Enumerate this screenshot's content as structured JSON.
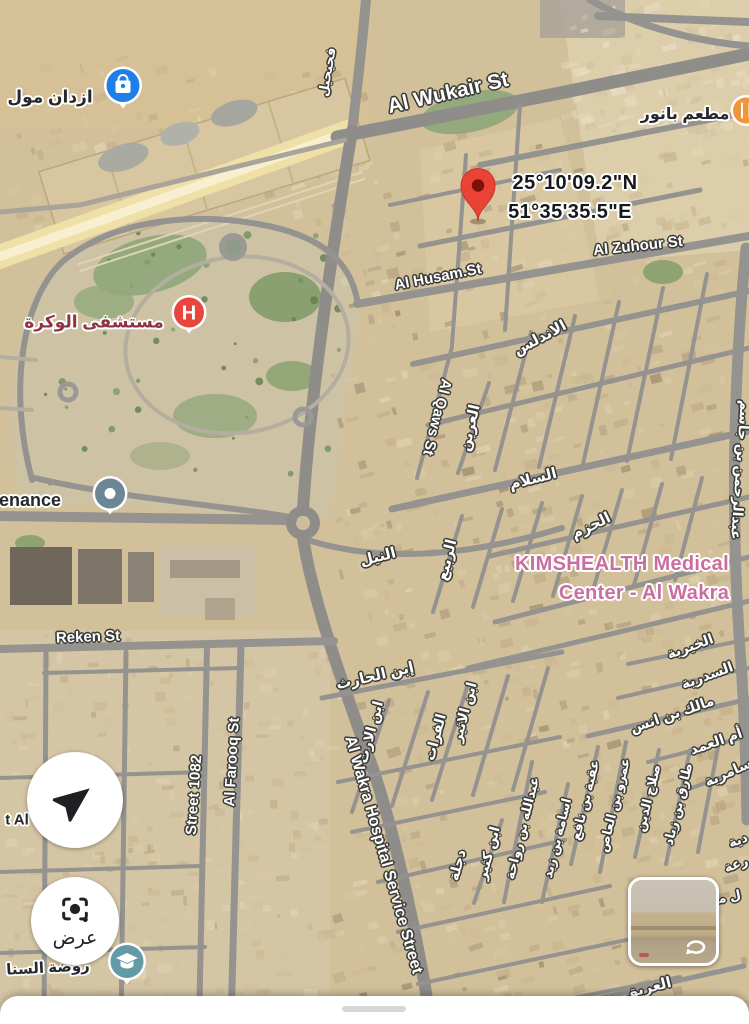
{
  "app": {
    "name": "maps-satellite-view"
  },
  "map": {
    "coordinates_label": {
      "line1": "25°10'09.2\"N",
      "line2": "51°35'35.5\"E"
    },
    "markers": {
      "hospital_letter": "H",
      "destination_pin": "dropped-pin",
      "mall": "shopping-bag-poi",
      "school": "graduation-cap-poi",
      "generic": "dot-poi",
      "restaurant": "restaurant-poi"
    },
    "labels": [
      {
        "t": "Al Wukair St",
        "x": 448,
        "y": 93,
        "r": -13,
        "s": 21,
        "c": "st",
        "n": "street-label-al-wukair"
      },
      {
        "t": "Al Husam.St",
        "x": 438,
        "y": 277,
        "r": -11,
        "s": 15,
        "c": "st",
        "n": "street-label-al-husam"
      },
      {
        "t": "Al Zuhour St",
        "x": 638,
        "y": 246,
        "r": -6,
        "s": 15,
        "c": "st",
        "n": "street-label-al-zuhour"
      },
      {
        "t": "Al Qaws St",
        "x": 437,
        "y": 417,
        "r": 104,
        "s": 15,
        "c": "st",
        "n": "street-label-al-qaws"
      },
      {
        "t": "Reken St",
        "x": 88,
        "y": 637,
        "r": -2,
        "s": 15,
        "c": "st",
        "n": "street-label-reken"
      },
      {
        "t": "Street 1082",
        "x": 194,
        "y": 795,
        "r": -86,
        "s": 15,
        "c": "st",
        "n": "street-label-1082"
      },
      {
        "t": "Al Farooq St",
        "x": 232,
        "y": 762,
        "r": -87,
        "s": 15,
        "c": "st",
        "n": "street-label-al-farooq"
      },
      {
        "t": "Al Wakra Hospital Service Street",
        "x": 383,
        "y": 855,
        "r": 74,
        "s": 16,
        "c": "st",
        "n": "street-label-hospital-service"
      },
      {
        "t": "العريق",
        "x": 648,
        "y": 988,
        "r": -14,
        "s": 15,
        "c": "st",
        "n": "street-label-al-areeq"
      },
      {
        "t": "الاندلس",
        "x": 540,
        "y": 338,
        "r": -28,
        "s": 15,
        "c": "st",
        "n": "street-label-al-andalus"
      },
      {
        "t": "العرين",
        "x": 470,
        "y": 428,
        "r": -77,
        "s": 15,
        "c": "st",
        "n": "street-label-al-areen"
      },
      {
        "t": "السلام",
        "x": 533,
        "y": 479,
        "r": -14,
        "s": 15,
        "c": "st",
        "n": "street-label-al-salam"
      },
      {
        "t": "الحزم",
        "x": 591,
        "y": 526,
        "r": -26,
        "s": 15,
        "c": "st",
        "n": "street-label-al-hazm"
      },
      {
        "t": "النيل",
        "x": 378,
        "y": 557,
        "r": -14,
        "s": 15,
        "c": "st",
        "n": "street-label-al-nile"
      },
      {
        "t": "الربيع",
        "x": 447,
        "y": 560,
        "r": -76,
        "s": 15,
        "c": "st",
        "n": "street-label-al-rabee"
      },
      {
        "t": "إبن الحارث",
        "x": 375,
        "y": 676,
        "r": -13,
        "s": 15,
        "c": "st",
        "n": "street-label-ibn-al-harith"
      },
      {
        "t": "ابن الارت",
        "x": 370,
        "y": 732,
        "r": -75,
        "s": 14,
        "c": "st",
        "n": "street-label-ibn-al-aratt"
      },
      {
        "t": "الفرات",
        "x": 435,
        "y": 737,
        "r": -75,
        "s": 14,
        "c": "st",
        "n": "street-label-al-furat"
      },
      {
        "t": "ابن الاثير",
        "x": 464,
        "y": 712,
        "r": -75,
        "s": 14,
        "c": "st",
        "n": "street-label-ibn-al-atheer"
      },
      {
        "t": "دجلة",
        "x": 457,
        "y": 865,
        "r": -75,
        "s": 14,
        "c": "st",
        "n": "street-label-dijla"
      },
      {
        "t": "ابن كثير",
        "x": 488,
        "y": 853,
        "r": -75,
        "s": 14,
        "c": "st",
        "n": "street-label-ibn-katheer"
      },
      {
        "t": "عبدالله بن رواحة",
        "x": 522,
        "y": 828,
        "r": -76,
        "s": 13,
        "c": "st",
        "n": "street-label-abdullah-bin-rawaha"
      },
      {
        "t": "اسامة بن زيد",
        "x": 557,
        "y": 838,
        "r": -76,
        "s": 13,
        "c": "st",
        "n": "street-label-usama-bin-zayd"
      },
      {
        "t": "عقبة بن نافع",
        "x": 585,
        "y": 800,
        "r": -76,
        "s": 13,
        "c": "st",
        "n": "street-label-uqba-bin-nafi"
      },
      {
        "t": "عمرو بن العاص",
        "x": 614,
        "y": 805,
        "r": -76,
        "s": 13,
        "c": "st",
        "n": "street-label-amr-bin-alaas"
      },
      {
        "t": "صلاح الدين",
        "x": 648,
        "y": 798,
        "r": -76,
        "s": 13,
        "c": "st",
        "n": "street-label-salah-aldin"
      },
      {
        "t": "طارق بن زياد",
        "x": 678,
        "y": 804,
        "r": -76,
        "s": 13,
        "c": "st",
        "n": "street-label-tariq-bin-ziyad"
      },
      {
        "t": "الخيرية",
        "x": 690,
        "y": 646,
        "r": -20,
        "s": 14,
        "c": "st",
        "n": "street-label-al-khairiya"
      },
      {
        "t": "السدرية",
        "x": 707,
        "y": 675,
        "r": -20,
        "s": 14,
        "c": "st",
        "n": "street-label-al-sidriya"
      },
      {
        "t": "مالك بن انس",
        "x": 672,
        "y": 714,
        "r": -19,
        "s": 14,
        "c": "st",
        "n": "street-label-malik-bin-anas"
      },
      {
        "t": "أم العمد",
        "x": 716,
        "y": 741,
        "r": -19,
        "s": 14,
        "c": "st",
        "n": "street-label-umm-al-amad"
      },
      {
        "t": "سامرية",
        "x": 728,
        "y": 772,
        "r": -24,
        "s": 14,
        "c": "st",
        "n": "street-label-samriya"
      },
      {
        "t": "عبدالرحمن بن جاسم",
        "x": 741,
        "y": 470,
        "r": 94,
        "s": 14,
        "c": "st",
        "n": "street-label-abdulrahman-bin-jassim"
      },
      {
        "t": "فحيحيل",
        "x": 327,
        "y": 72,
        "r": -80,
        "s": 13,
        "c": "st",
        "n": "street-label-vertical-top"
      },
      {
        "t": "دية",
        "x": 738,
        "y": 840,
        "r": -20,
        "s": 13,
        "c": "st",
        "n": "street-label-fragment-1"
      },
      {
        "t": "رعة",
        "x": 736,
        "y": 864,
        "r": -20,
        "s": 13,
        "c": "st",
        "n": "street-label-fragment-2"
      },
      {
        "t": "ل ما",
        "x": 727,
        "y": 897,
        "r": -12,
        "s": 13,
        "c": "st",
        "n": "street-label-fragment-3"
      },
      {
        "t": "ازدان مول",
        "x": 50,
        "y": 97,
        "r": 0,
        "s": 17,
        "c": "poi",
        "n": "poi-label-ezdan-mall"
      },
      {
        "t": "مطعم بانور",
        "x": 685,
        "y": 115,
        "r": 0,
        "s": 16,
        "c": "poi",
        "n": "poi-label-banoor-restaurant"
      },
      {
        "t": "enance",
        "x": 30,
        "y": 500,
        "r": 0,
        "s": 18,
        "c": "poi",
        "n": "poi-label-maintenance-partial"
      },
      {
        "t": "t Al",
        "x": 17,
        "y": 820,
        "r": 0,
        "s": 15,
        "c": "poi",
        "n": "poi-label-partial-left"
      },
      {
        "t": "روضة السنا",
        "x": 48,
        "y": 968,
        "r": -3,
        "s": 15,
        "c": "poi",
        "n": "poi-label-school-partial"
      },
      {
        "t": "مستشفى الوكرة",
        "x": 94,
        "y": 322,
        "r": 0,
        "s": 17,
        "c": "hosp",
        "n": "poi-label-al-wakra-hospital"
      },
      {
        "t": "KIMSHEALTH Medical",
        "x": 622,
        "y": 564,
        "r": 0,
        "s": 20,
        "c": "kims",
        "n": "poi-label-kimshealth-line1"
      },
      {
        "t": "Center - Al Wakra",
        "x": 644,
        "y": 593,
        "r": 0,
        "s": 20,
        "c": "kims",
        "n": "poi-label-kimshealth-line2"
      },
      {
        "t": "25°10'09.2\"N",
        "x": 575,
        "y": 183,
        "r": 0,
        "s": 20,
        "c": "coords",
        "n": "pin-coordinates-line1"
      },
      {
        "t": "51°35'35.5\"E",
        "x": 570,
        "y": 212,
        "r": 0,
        "s": 20,
        "c": "coords",
        "n": "pin-coordinates-line2"
      }
    ]
  },
  "colors": {
    "pin_red": "#EA4335",
    "pin_dot": "#7C1206",
    "hospital_red": "#E8453C",
    "mall_blue": "#1F7FE8",
    "school_teal": "#649AA6",
    "generic_poi_slate": "#6B8795",
    "restaurant_orange": "#F0953A",
    "kims_pink": "#C96F9F",
    "hospital_label_maroon": "#8E3344",
    "road_gray": "#95938F",
    "highway_yellow": "#EFE0A8",
    "sand_base": "#D2C09A"
  },
  "controls": {
    "navigation_button": {
      "icon": "navigation-arrow"
    },
    "lens_button": {
      "label": "عرض",
      "icon": "camera-lens"
    },
    "street_view_thumbnail": {
      "icon": "loop-arrow"
    }
  },
  "bottom_sheet": {
    "handle": "drag-handle"
  }
}
